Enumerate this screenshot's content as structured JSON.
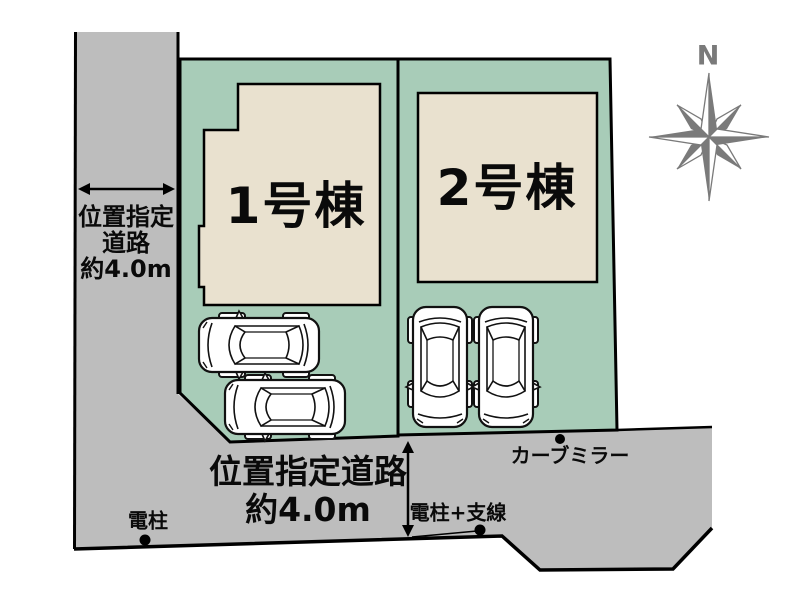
{
  "colors": {
    "road_gray": "#bdbdbd",
    "lot_green": "#a8ccb8",
    "building_beige": "#e9e1cf",
    "outline_black": "#000000",
    "compass_gray": "#7a7a7a",
    "car_white": "#ffffff"
  },
  "lots": [
    {
      "label": "1号棟"
    },
    {
      "label": "2号棟"
    }
  ],
  "left_road": {
    "lines": [
      "位置指定",
      "道路",
      "約4.0m"
    ]
  },
  "bottom_road": {
    "lines": [
      "位置指定道路",
      "約4.0m"
    ]
  },
  "markers": {
    "utility_pole": "電柱",
    "utility_pole_with_guy_wire": "電柱+支線",
    "curve_mirror": "カーブミラー"
  },
  "compass": {
    "north_label": "N"
  }
}
